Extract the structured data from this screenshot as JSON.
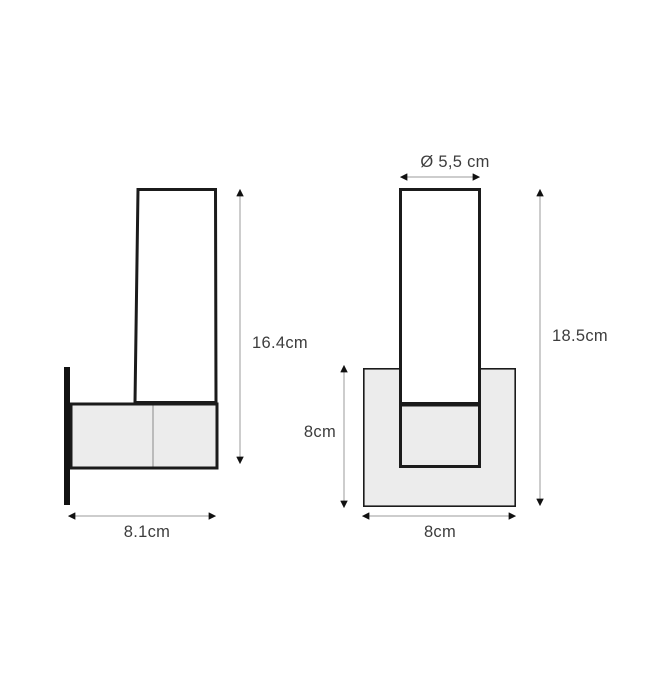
{
  "diagram": {
    "side_view": {
      "height_label": "16.4cm",
      "width_label": "8.1cm"
    },
    "front_view": {
      "diameter_label": "Ø 5,5 cm",
      "height_label": "18.5cm",
      "bracket_height_label": "8cm",
      "width_label": "8cm"
    },
    "colors": {
      "outline": "#1b1b1b",
      "panel_fill": "#ececec",
      "dimension_line": "#9b9b9b",
      "arrowhead": "#111111",
      "label_text": "#3d3d3d",
      "background": "#ffffff"
    }
  }
}
